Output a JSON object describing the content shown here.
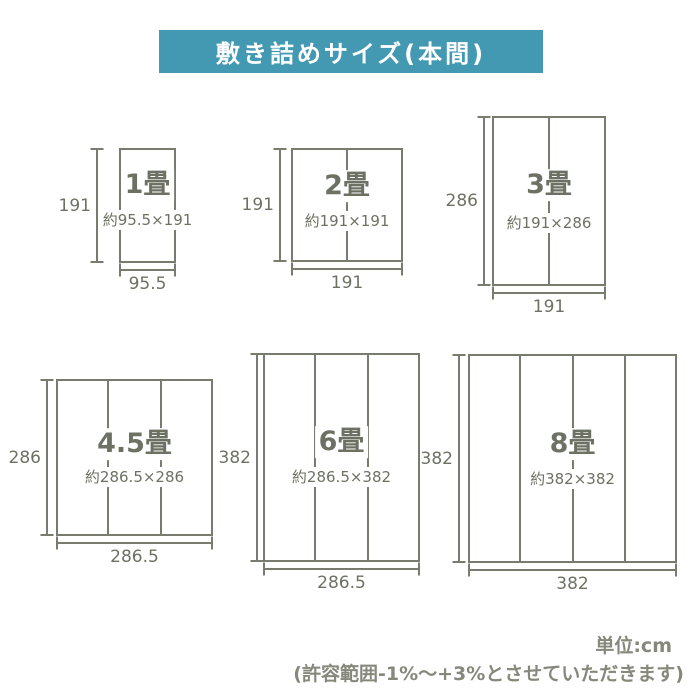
{
  "title": "敷き詰めサイズ(本間)",
  "unit_note": "単位:cm",
  "tolerance_note": "(許容範囲-1%〜+3%とさせていただきます)",
  "colors": {
    "banner_teal": "#4499b2",
    "text_olive_gray": "#6d7163",
    "line_olive_gray": "#787c6e",
    "footer_gray": "#85887b"
  },
  "sizes": [
    {
      "id": "1jo",
      "label": "1畳",
      "dimensions_text": "約95.5×191",
      "width_cm": 95.5,
      "height_cm": 191,
      "width_label": "95.5",
      "height_label": "191",
      "mat_columns": 1
    },
    {
      "id": "2jo",
      "label": "2畳",
      "dimensions_text": "約191×191",
      "width_cm": 191,
      "height_cm": 191,
      "width_label": "191",
      "height_label": "191",
      "mat_columns": 2
    },
    {
      "id": "3jo",
      "label": "3畳",
      "dimensions_text": "約191×286",
      "width_cm": 191,
      "height_cm": 286,
      "width_label": "191",
      "height_label": "286",
      "mat_columns": 2
    },
    {
      "id": "45jo",
      "label": "4.5畳",
      "dimensions_text": "約286.5×286",
      "width_cm": 286.5,
      "height_cm": 286,
      "width_label": "286.5",
      "height_label": "286",
      "mat_columns": 3
    },
    {
      "id": "6jo",
      "label": "6畳",
      "dimensions_text": "約286.5×382",
      "width_cm": 286.5,
      "height_cm": 382,
      "width_label": "286.5",
      "height_label": "382",
      "mat_columns": 3
    },
    {
      "id": "8jo",
      "label": "8畳",
      "dimensions_text": "約382×382",
      "width_cm": 382,
      "height_cm": 382,
      "width_label": "382",
      "height_label": "382",
      "mat_columns": 4
    }
  ]
}
